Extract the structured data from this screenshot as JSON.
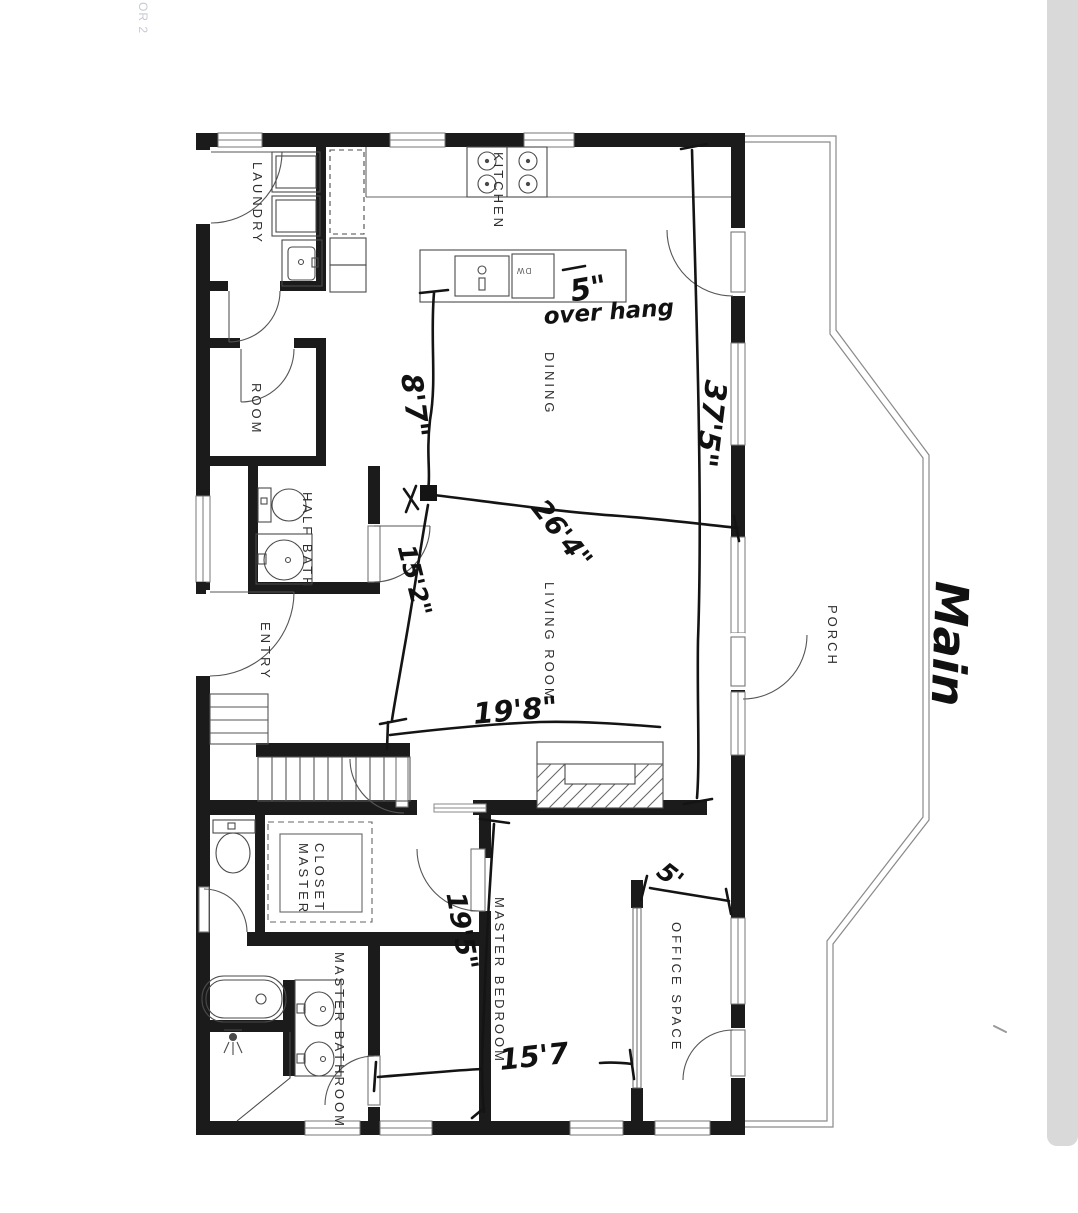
{
  "rooms": {
    "laundry": "LAUNDRY",
    "kitchen": "KITCHEN",
    "dining": "DINING",
    "room": "ROOM",
    "half_bath": "HALF BATH",
    "entry": "ENTRY",
    "living_room": "LIVING ROOM",
    "porch": "PORCH",
    "master_closet_line1": "MASTER",
    "master_closet_line2": "CLOSET",
    "master_bedroom": "MASTER BEDROOM",
    "master_bathroom": "MASTER BATHROOM",
    "office_space": "OFFICE SPACE"
  },
  "dimensions": {
    "d_8_7": "8'7\"",
    "d_15_2": "15'2\"",
    "d_26_4": "26'4\"",
    "d_37_5": "37'5\"",
    "d_19_8": "19'8\"",
    "d_19_5": "19'5\"",
    "d_15_7": "15'7",
    "d_5_office": "5'",
    "overhang_value": "5\"",
    "overhang_word": "over hang"
  },
  "annotations": {
    "title": "Main",
    "corner_text": "OR 2",
    "dishwasher": "DW"
  },
  "colors": {
    "wall": "#1b1b1b",
    "paper": "#ffffff",
    "ink": "#141414",
    "scan_strip": "#d9d9d9",
    "faint_text": "#c6cad3"
  }
}
